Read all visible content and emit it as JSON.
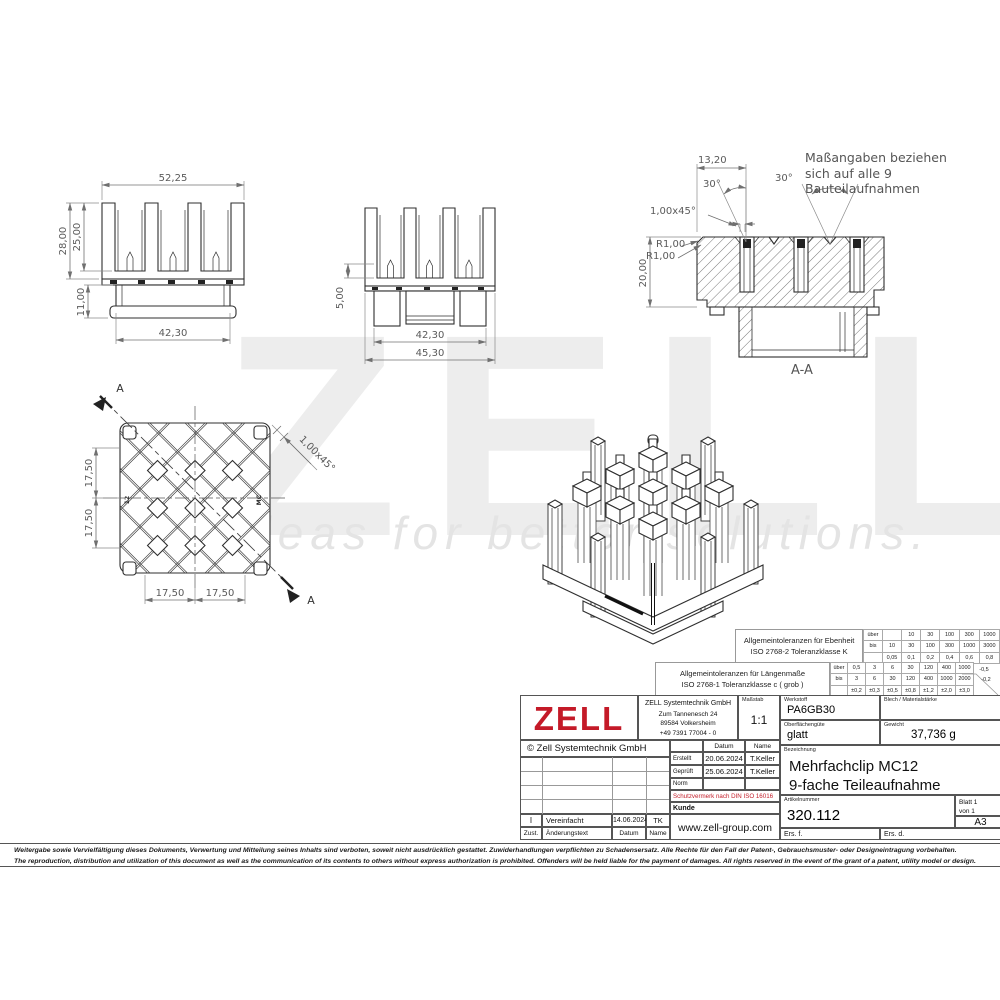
{
  "watermark": {
    "brand": "ZELL",
    "tagline": "ideas for better solutions."
  },
  "note": {
    "line1": "Maßangaben beziehen",
    "line2": "sich auf alle 9 Bauteilaufnahmen"
  },
  "views": {
    "front": {
      "dim_width_top": "52,25",
      "dim_height_outer": "28,00",
      "dim_height_inner": "25,00",
      "dim_width_base": "42,30",
      "dim_height_base": "11,00"
    },
    "side": {
      "dim_stub": "5,00",
      "dim_width_inner": "42,30",
      "dim_width_outer": "45,30"
    },
    "section": {
      "label": "A-A",
      "dim_top": "13,20",
      "angle_left": "30°",
      "angle_right": "30°",
      "chamfer": "1,00x45°",
      "radius_1": "R1,00",
      "radius_2": "R1,00",
      "dim_height": "20,00"
    },
    "top": {
      "pitch_v1": "17,50",
      "pitch_v2": "17,50",
      "pitch_h1": "17,50",
      "pitch_h2": "17,50",
      "chamfer": "1,00x45°",
      "cut_label_start": "A",
      "cut_label_end": "A",
      "marking_left": "12",
      "marking_right": "MC"
    }
  },
  "tolerances": {
    "flatness": {
      "title_1": "Allgemeintoleranzen für Ebenheit",
      "title_2": "ISO 2768-2 Toleranzklasse K",
      "row_over": "über",
      "row_to": "bis",
      "over": [
        "",
        "10",
        "30",
        "100",
        "300",
        "1000"
      ],
      "to": [
        "10",
        "30",
        "100",
        "300",
        "1000",
        "3000"
      ],
      "values": [
        "0,05",
        "0,1",
        "0,2",
        "0,4",
        "0,6",
        "0,8"
      ]
    },
    "length": {
      "title_1": "Allgemeintoleranzen für Längenmaße",
      "title_2": "ISO 2768-1 Toleranzklasse c ( grob )",
      "row_over": "über",
      "row_to": "bis",
      "over": [
        "0,5",
        "3",
        "6",
        "30",
        "120",
        "400",
        "1000"
      ],
      "to": [
        "3",
        "6",
        "30",
        "120",
        "400",
        "1000",
        "2000"
      ],
      "values": [
        "±0,2",
        "±0,3",
        "±0,5",
        "±0,8",
        "±1,2",
        "±2,0",
        "±3,0"
      ],
      "edge_note_1": "-0,5",
      "edge_note_2": "-0,2"
    }
  },
  "title_block": {
    "logo_text": "ZELL",
    "company_name": "ZELL Systemtechnik GmbH",
    "company_street": "Zum Tannenesch 24",
    "company_city": "89584 Volkersheim",
    "company_phone": "+49 7391 77004 - 0",
    "masstab_label": "Maßstab",
    "masstab_value": "1:1",
    "copyright": "© Zell Systemtechnik GmbH 2019",
    "col_datum": "Datum",
    "col_name": "Name",
    "created_label": "Erstellt",
    "created_date": "20.06.2024",
    "created_name": "T.Keller",
    "checked_label": "Geprüft",
    "checked_date": "25.06.2024",
    "checked_name": "T.Keller",
    "norm_label": "Norm",
    "schutzvermerk": "Schutzvermerk nach DIN ISO 16016",
    "kunde_label": "Kunde",
    "rev_zust": "I",
    "rev_text": "Vereinfacht",
    "rev_date": "14.06.2024",
    "rev_name": "TK",
    "rev_col_zust": "Zust.",
    "rev_col_text": "Änderungstext",
    "rev_col_datum": "Datum",
    "rev_col_name": "Name",
    "website": "www.zell-group.com",
    "werkstoff_label": "Werkstoff",
    "werkstoff_value": "PA6GB30",
    "blech_label": "Blech / Materialstärke",
    "oberflaeche_label": "Oberflächengüte",
    "oberflaeche_value": "glatt",
    "gewicht_label": "Gewicht",
    "gewicht_value": "37,736 g",
    "bezeichnung_label": "Bezeichnung",
    "bezeichnung_line1": "Mehrfachclip MC12",
    "bezeichnung_line2": "9-fache Teileaufnahme",
    "artikel_label": "Artikelnummer",
    "artikel_value": "320.112",
    "blatt": "Blatt  1",
    "von": "von  1",
    "format": "A3",
    "ers_f": "Ers. f.",
    "ers_d": "Ers. d."
  },
  "disclaimer": {
    "de": "Weitergabe sowie Vervielfältigung dieses Dokuments, Verwertung und Mitteilung seines Inhalts sind verboten, soweit nicht ausdrücklich gestattet. Zuwiderhandlungen verpflichten zu Schadensersatz. Alle Rechte für den Fall der Patent-, Gebrauchsmuster- oder Designeintragung vorbehalten.",
    "en": "The reproduction, distribution and utilization of this document as well as the communication of its contents to others without express authorization is prohibited. Offenders will be held liable for the payment of damages. All rights reserved in the event of the grant of a patent, utility model or design."
  },
  "colors": {
    "accent_red": "#c41a28",
    "line": "#2f2f2f",
    "dim_gray": "#707070",
    "watermark": "#ededed"
  }
}
